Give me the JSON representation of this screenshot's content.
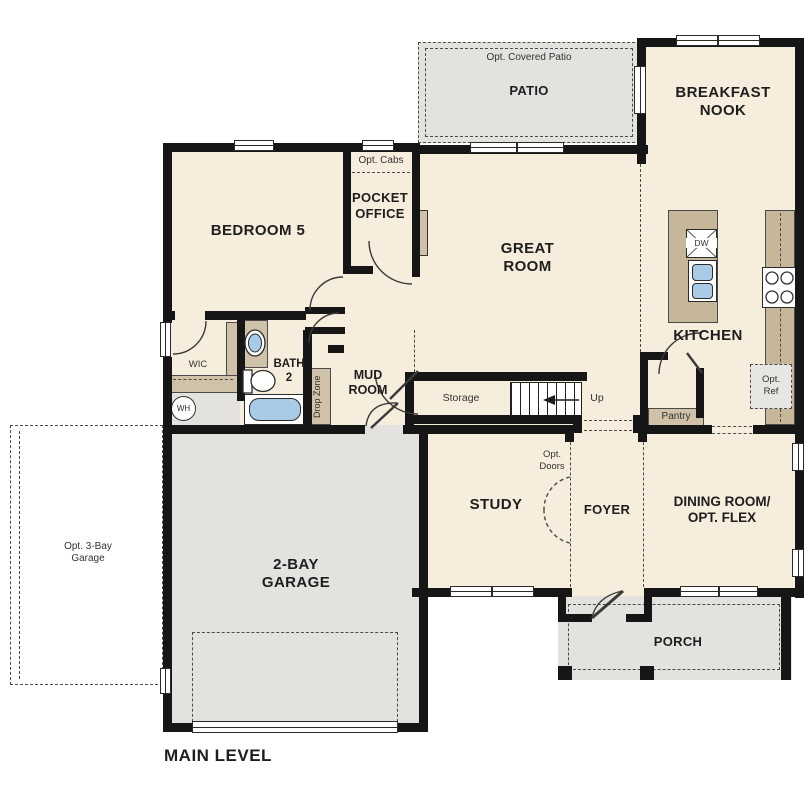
{
  "plan_title": "MAIN LEVEL",
  "colors": {
    "floor": "#f6eddc",
    "exterior_concrete": "#e3e2df",
    "cabinetry_tan": "#c6b79a",
    "fixture_blue": "#a9cbe5",
    "wall": "#161616"
  },
  "labels": {
    "opt_covered_patio": "Opt. Covered Patio",
    "patio": "PATIO",
    "breakfast_nook": "BREAKFAST\nNOOK",
    "bedroom5": "BEDROOM 5",
    "opt_cabs": "Opt. Cabs",
    "pocket_office": "POCKET\nOFFICE",
    "great_room": "GREAT\nROOM",
    "kitchen": "KITCHEN",
    "dishwasher": "DW",
    "opt_ref": "Opt.\nRef",
    "pantry": "Pantry",
    "wic": "WIC",
    "bath2": "BATH\n2",
    "water_heater": "WH",
    "drop_zone": "Drop Zone",
    "mud_room": "MUD\nROOM",
    "storage": "Storage",
    "up": "Up",
    "opt_doors": "Opt.\nDoors",
    "study": "STUDY",
    "foyer": "FOYER",
    "dining_room": "DINING ROOM/\nOPT. FLEX",
    "opt_3bay_garage": "Opt. 3-Bay\nGarage",
    "garage_2bay": "2-BAY\nGARAGE",
    "porch": "PORCH",
    "main_level": "MAIN LEVEL"
  }
}
